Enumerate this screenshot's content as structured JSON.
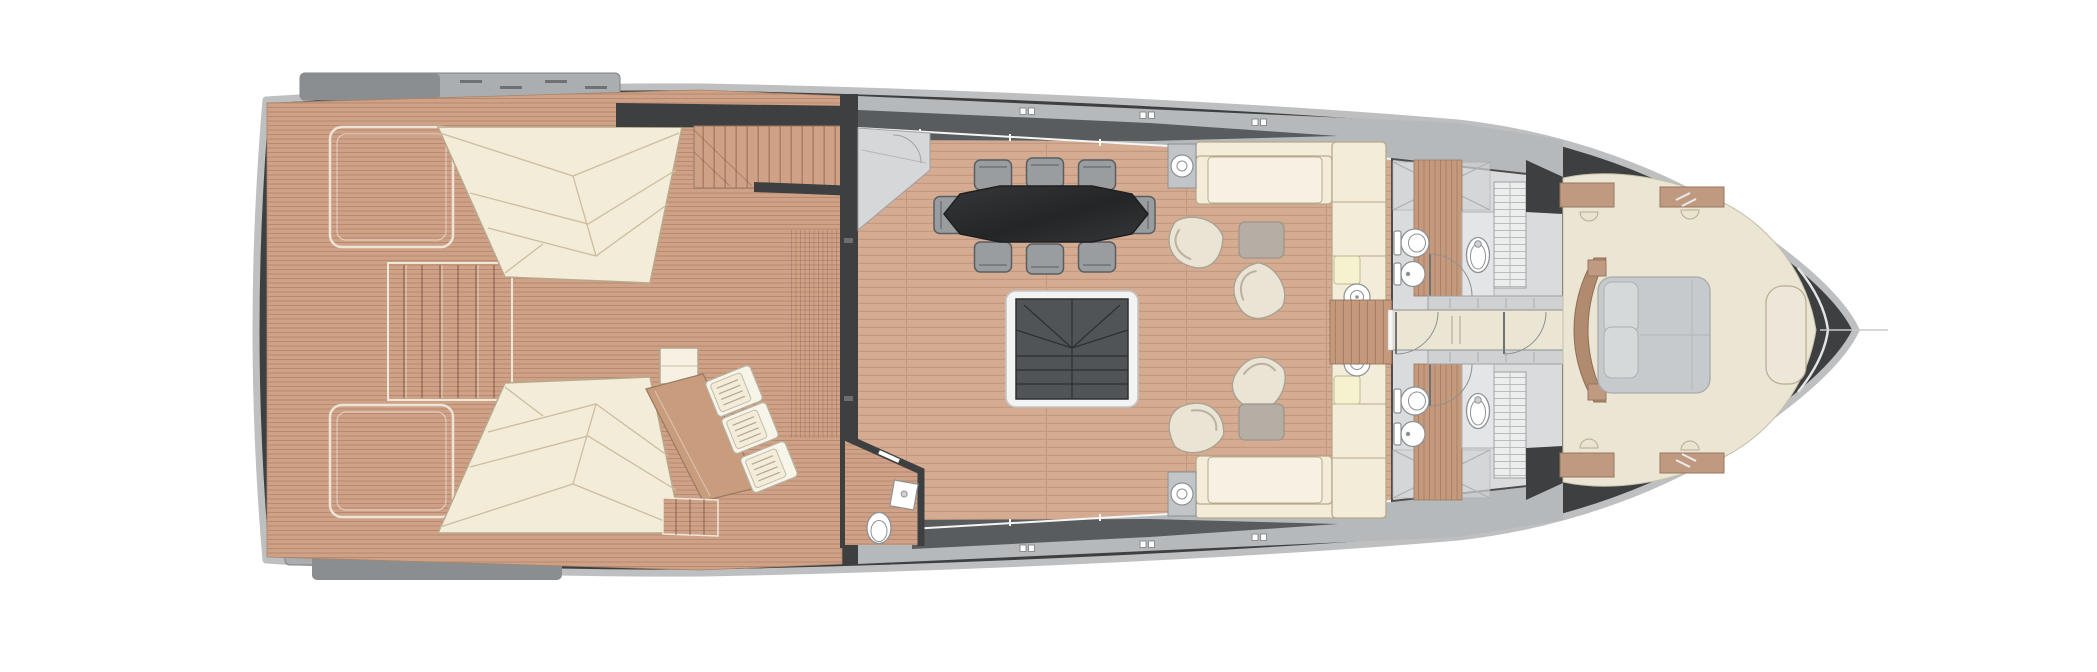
{
  "meta": {
    "type": "yacht-deck-floor-plan",
    "view": "top-down",
    "orientation": {
      "bow": "right",
      "stern": "left"
    }
  },
  "colors": {
    "background": "#ffffff",
    "hull_dark": "#3d3f41",
    "hull_rim": "#bdbfc0",
    "deck_light": "#b6b9bb",
    "deck_dark": "#595c5e",
    "slab_light": "#abaeb0",
    "slab_dark": "#8b8e91",
    "teak_base": "#cfa287",
    "teak_stripe": "#b78b72",
    "plank_base": "#d5ac91",
    "plank_stripe": "#c39980",
    "cream": "#f2ecd9",
    "cream_light": "#f6f1e3",
    "cream_outline": "#b9a98c",
    "pale_yellow": "#f6f2cf",
    "chair_gray": "#9a9da0",
    "chair_edge": "#5b5e61",
    "table_dark": "#35373a",
    "table_dark2": "#232527",
    "stair_dark": "#515456",
    "stair_frame": "#f2f3f3",
    "bath_floor": "#dadbdc",
    "fixture_white": "#ffffff",
    "fixture_outline": "#8e9193",
    "carpet": "#ebe5d3",
    "bed_gray": "#c6cacc",
    "pillow_gray": "#d6d9da",
    "headboard_wood": "#b18b6f",
    "cabinet_wood": "#c09a80",
    "slat_base": "#c59a7c",
    "slat_stripe": "#ab8066",
    "wardrobe": "#eceded",
    "ottoman_gray": "#b5aea4",
    "armchair_cream": "#e9e4d4",
    "wall_white": "#f5f5f5"
  },
  "areas": [
    {
      "id": "stern-platforms"
    },
    {
      "id": "aft-deck"
    },
    {
      "id": "flybridge-stairs"
    },
    {
      "id": "salon"
    },
    {
      "id": "day-head"
    },
    {
      "id": "bathroom-port"
    },
    {
      "id": "bathroom-starboard"
    },
    {
      "id": "corridor"
    },
    {
      "id": "master-cabin"
    },
    {
      "id": "bow-deck"
    }
  ],
  "inventory": {
    "sun_pads": 2,
    "teak_lounge_platforms": 2,
    "sun_loungers": 3,
    "outdoor_wood_tables": 1,
    "outdoor_side_tables": 1,
    "stern_step_treads": 6,
    "dining_table": 1,
    "dining_chairs": 8,
    "sofas": 2,
    "armchairs": 4,
    "ottomans": 2,
    "lamp_side_tables": 2,
    "round_side_tables": 2,
    "upholstered_stools": 2,
    "stairwells": 2,
    "bathrooms": 2,
    "toilets": 3,
    "bidets": 2,
    "sinks": 3,
    "showers": 2,
    "wardrobes": 2,
    "interior_doors": 4,
    "double_beds": 1,
    "pillows": 2,
    "bedside_cabinets": 4,
    "bow_bench": 1,
    "deck_cleats": 6
  }
}
